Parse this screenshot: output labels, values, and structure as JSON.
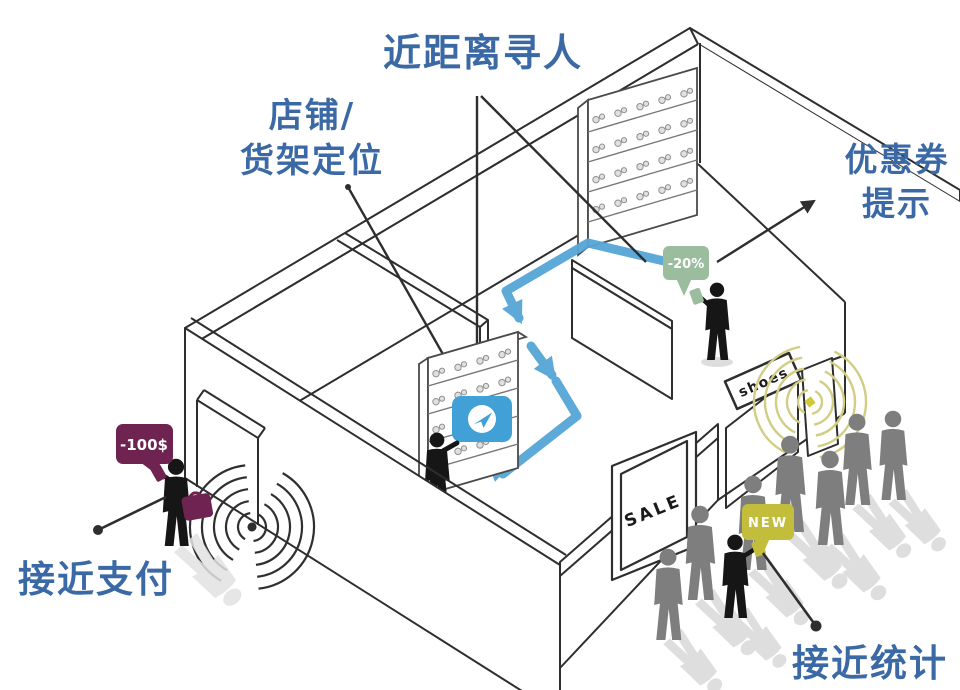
{
  "labels": {
    "find_person": "近距离寻人",
    "shelf_location": "店铺/\n货架定位",
    "coupon": "优惠券\n提示",
    "payment": "接近支付",
    "stats": "接近统计"
  },
  "bubbles": {
    "payment": {
      "text": "-100$",
      "color": "#6f2350"
    },
    "coupon": {
      "text": "-20%",
      "color": "#9bbd9d"
    },
    "new": {
      "text": "NEW",
      "color": "#c2be3b"
    }
  },
  "signs": {
    "sale": "SALE",
    "shoes": "shoes"
  },
  "scene": {
    "crowd_count": 7,
    "black_figure_count": 4,
    "icons": [
      "navigation-icon",
      "signal-waves-icon",
      "beacon-icon",
      "speech-bubble-icon"
    ],
    "colors": {
      "label_blue": "#3b69a5",
      "path_blue": "#55a5d6",
      "badge_blue": "#41a0d6",
      "maroon": "#6f2350",
      "sage_green": "#9bbd9d",
      "olive": "#c2be3b",
      "wave_olive": "#d2cd85",
      "gray_figure": "#7e7e7e",
      "black_figure": "#161616",
      "line": "#2e2e2e"
    }
  }
}
